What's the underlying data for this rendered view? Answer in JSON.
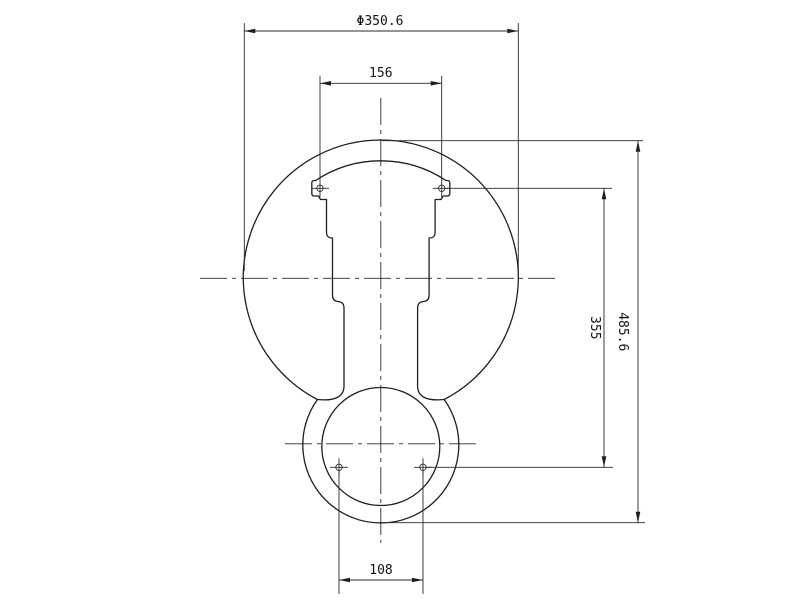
{
  "drawing": {
    "type": "engineering-dimension-drawing",
    "background_color": "#ffffff",
    "line_color": "#1f1f1f",
    "dimensions": {
      "top_diameter": "Φ350.6",
      "upper_hole_spacing": "156",
      "hole_row_distance": "355",
      "overall_height": "485.6",
      "lower_hole_spacing": "108"
    }
  }
}
